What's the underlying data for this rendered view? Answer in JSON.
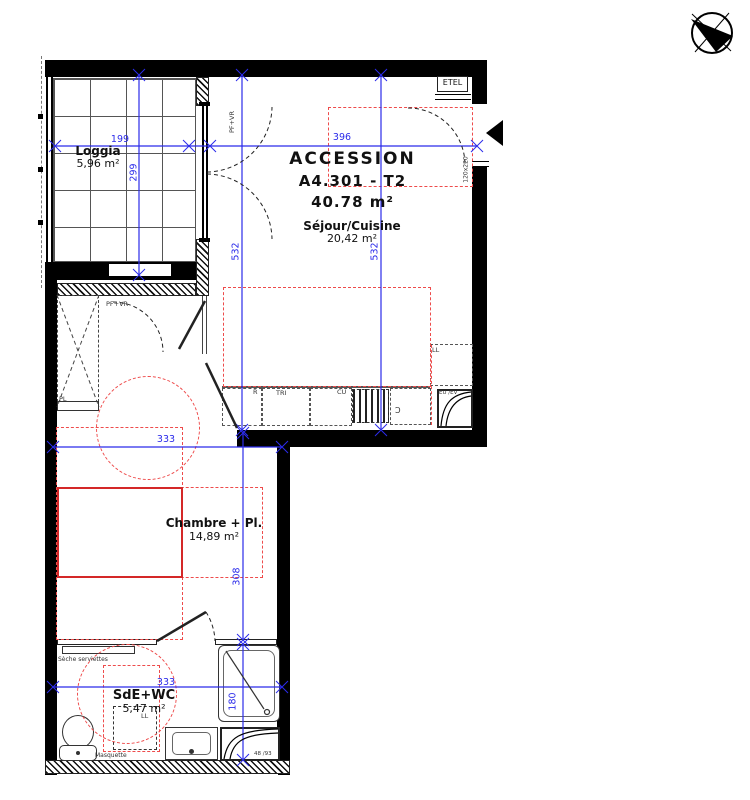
{
  "title": {
    "program": "ACCESSION",
    "lot": "A4.301 - T2",
    "area": "40.78 m²"
  },
  "rooms": {
    "loggia": {
      "name": "Loggia",
      "area": "5,96 m²"
    },
    "sejour": {
      "name": "Séjour/Cuisine",
      "area": "20,42 m²"
    },
    "chambre": {
      "name": "Chambre + Pl.",
      "area": "14,89 m²"
    },
    "sde": {
      "name": "SdE+WC",
      "area": "5,47 m²"
    }
  },
  "dimensions": {
    "loggia_w": "199",
    "loggia_h": "299",
    "sejour_w": "396",
    "sejour_h_left": "532",
    "sejour_h_right": "532",
    "chambre_w": "333",
    "chambre_h": "308",
    "sde_w": "333",
    "sde_h": "180"
  },
  "labels": {
    "etel": "ETEL",
    "pf_vr_window": "PF+VR",
    "pf_vr_door": "PF+VR",
    "placard": "PL",
    "fridge": "R",
    "waste_sorting": "TRI",
    "cooktop": "CU",
    "washer_kitchen": "LL",
    "washer_sde": "LL",
    "door_size": "120x220",
    "towel_dryer": "Sèche serviettes",
    "masquette": "Masquette",
    "duct_kitchen": "EU /EV",
    "duct_sde": "48 /93",
    "tap_glyph": "Ɔ"
  },
  "colors": {
    "dim": "#2b2bea",
    "red": "#ee4b4b",
    "bedred": "#d42828",
    "wall": "#000000"
  }
}
